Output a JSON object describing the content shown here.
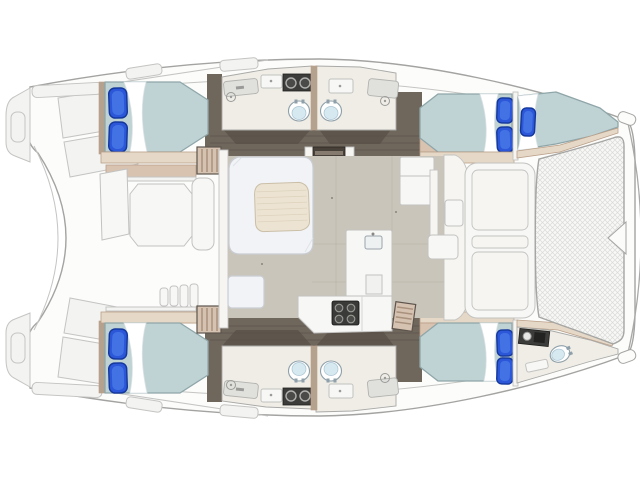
{
  "figure": {
    "description": "Top-view interior floor plan of a four-cabin sailing catamaran: four double cabins with blue pillows, four central bathrooms with back-to-back toilets, bow crew berth, bow WC, central saloon with dinette table and galley, aft cockpit (ghosted) and bow trampoline.",
    "width_px": 640,
    "height_px": 480
  },
  "features": {
    "double_cabins": 4,
    "bow_berths": 1,
    "bow_bathrooms": 1,
    "center_bathrooms": 4,
    "toilets": 5,
    "blue_pillows": 9,
    "stairways": 4,
    "galley_burners": 4,
    "trampoline": true,
    "dinette_table": true
  },
  "colors": {
    "hull_fill": "#fcfcfb",
    "hull_outline": "#a3a3a1",
    "ghost_fill": "#f3f3f1",
    "ghost_stroke": "#c4c4c2",
    "room_stroke": "#a9a9a7",
    "corridor": "#6f665c",
    "corridor_dark": "#5e564d",
    "corridor_seam": "#554d45",
    "bathroom": "#efede6",
    "wall_white": "#f6f5f2",
    "counter_dark": "#3c3c3a",
    "sink_metal": "#4a4a48",
    "toilet_water": "#d6e8f0",
    "toilet_stroke": "#8fa0aa",
    "cabinet_gray": "#e0e0dc",
    "duvet": "#bfd2d4",
    "duvet_stroke": "#8fa6a9",
    "sheet": "#ffffff",
    "pillow": "#2b57d8",
    "pillow_stroke": "#14379b",
    "pillow_hi": "#4272e4",
    "tan": "#d8c3b1",
    "tan_light": "#e6d8c7",
    "tan_wall": "#b5a28e",
    "tan_stroke": "#b99f88",
    "stairs_tan": "#d6c2b0",
    "stairs_stroke": "#5d554d",
    "stairs_stripe": "#a8917d",
    "stair_dark": "#48413a",
    "stair_tread": "#857b6e",
    "saloon_floor": "#cac5ba",
    "floor_seam": "#bcb7ac",
    "sofa": "#f1f3f6",
    "sofa_stroke": "#c9cdd4",
    "table": "#ece3d2",
    "table_stripe": "#ddd2bc",
    "table_stroke": "#cbbfa8",
    "white_furn": "#f7f7f5",
    "furn_stroke": "#c2c2c0",
    "tramp": "#f8f8f6",
    "tramp_mesh": "#dadad8",
    "tramp_stroke": "#a5a5a3",
    "stove": "#3a3a38"
  }
}
